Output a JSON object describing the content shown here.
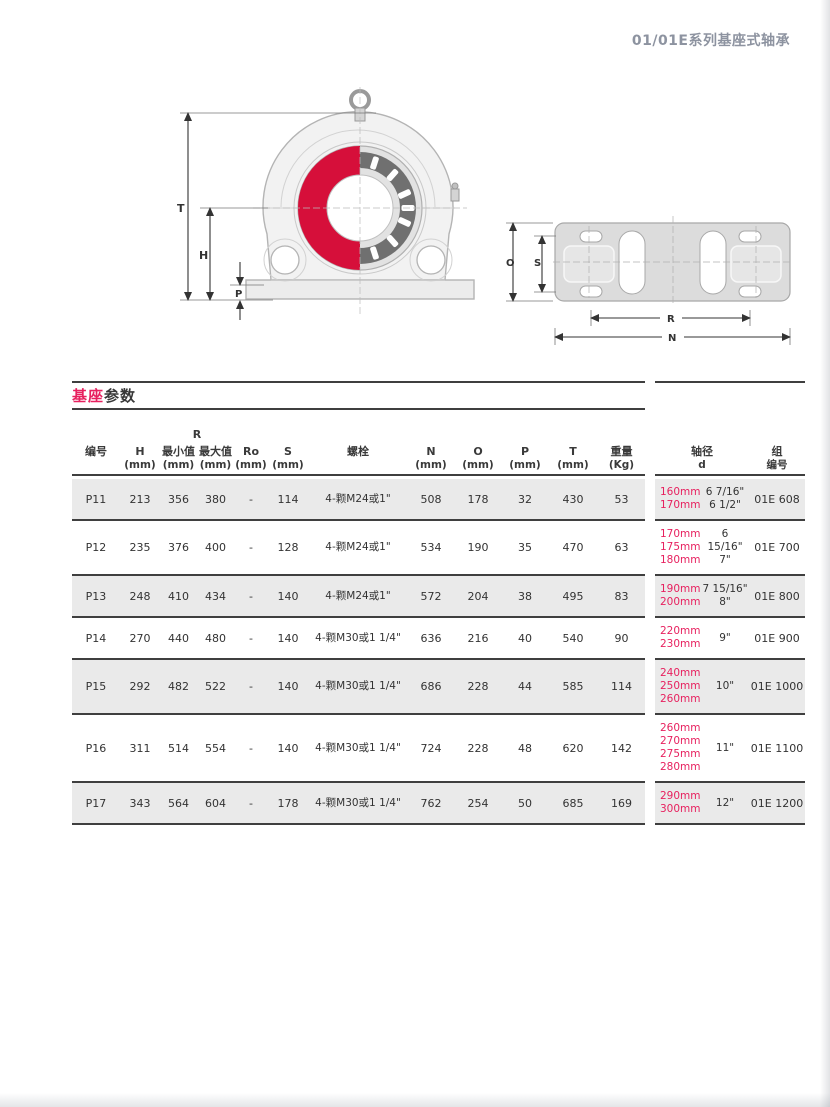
{
  "header": {
    "title": "01/01E系列基座式轴承"
  },
  "section": {
    "title_accent": "基座",
    "title_rest": "参数"
  },
  "diagram": {
    "labels": {
      "T": "T",
      "H": "H",
      "P": "P",
      "O": "O",
      "S": "S",
      "R": "R",
      "N": "N"
    }
  },
  "table": {
    "r_group_label": "R",
    "columns": [
      {
        "key": "id",
        "label": "编号",
        "unit": ""
      },
      {
        "key": "h",
        "label": "H",
        "unit": "(mm)"
      },
      {
        "key": "r_min",
        "label": "最小值",
        "unit": "(mm)"
      },
      {
        "key": "r_max",
        "label": "最大值",
        "unit": "(mm)"
      },
      {
        "key": "ro",
        "label": "Ro",
        "unit": "(mm)"
      },
      {
        "key": "s",
        "label": "S",
        "unit": "(mm)"
      },
      {
        "key": "bolt",
        "label": "螺栓",
        "unit": ""
      },
      {
        "key": "n",
        "label": "N",
        "unit": "(mm)"
      },
      {
        "key": "o",
        "label": "O",
        "unit": "(mm)"
      },
      {
        "key": "p",
        "label": "P",
        "unit": "(mm)"
      },
      {
        "key": "t",
        "label": "T",
        "unit": "(mm)"
      },
      {
        "key": "weight",
        "label": "重量",
        "unit": "(Kg)"
      }
    ],
    "right_columns": [
      {
        "label": "轴径",
        "sub": "d"
      },
      {
        "label": "组",
        "sub": "编号"
      }
    ],
    "rows": [
      {
        "id": "P11",
        "h": "213",
        "r_min": "356",
        "r_max": "380",
        "ro": "-",
        "s": "114",
        "bolt": "4-颗M24或1\"",
        "n": "508",
        "o": "178",
        "p": "32",
        "t": "430",
        "weight": "53",
        "d_mm": [
          "160mm",
          "170mm"
        ],
        "d_inch": [
          "6 7/16\"",
          "6 1/2\""
        ],
        "group": "01E 608",
        "shaded": true
      },
      {
        "id": "P12",
        "h": "235",
        "r_min": "376",
        "r_max": "400",
        "ro": "-",
        "s": "128",
        "bolt": "4-颗M24或1\"",
        "n": "534",
        "o": "190",
        "p": "35",
        "t": "470",
        "weight": "63",
        "d_mm": [
          "170mm",
          "175mm",
          "180mm"
        ],
        "d_inch": [
          "6",
          "15/16\"",
          "7\""
        ],
        "group": "01E 700",
        "shaded": false
      },
      {
        "id": "P13",
        "h": "248",
        "r_min": "410",
        "r_max": "434",
        "ro": "-",
        "s": "140",
        "bolt": "4-颗M24或1\"",
        "n": "572",
        "o": "204",
        "p": "38",
        "t": "495",
        "weight": "83",
        "d_mm": [
          "190mm",
          "200mm"
        ],
        "d_inch": [
          "7 15/16\"",
          "8\""
        ],
        "group": "01E 800",
        "shaded": true
      },
      {
        "id": "P14",
        "h": "270",
        "r_min": "440",
        "r_max": "480",
        "ro": "-",
        "s": "140",
        "bolt": "4-颗M30或1 1/4\"",
        "n": "636",
        "o": "216",
        "p": "40",
        "t": "540",
        "weight": "90",
        "d_mm": [
          "220mm",
          "230mm"
        ],
        "d_inch": [
          "9\""
        ],
        "group": "01E 900",
        "shaded": false
      },
      {
        "id": "P15",
        "h": "292",
        "r_min": "482",
        "r_max": "522",
        "ro": "-",
        "s": "140",
        "bolt": "4-颗M30或1 1/4\"",
        "n": "686",
        "o": "228",
        "p": "44",
        "t": "585",
        "weight": "114",
        "d_mm": [
          "240mm",
          "250mm",
          "260mm"
        ],
        "d_inch": [
          "10\""
        ],
        "group": "01E 1000",
        "shaded": true
      },
      {
        "id": "P16",
        "h": "311",
        "r_min": "514",
        "r_max": "554",
        "ro": "-",
        "s": "140",
        "bolt": "4-颗M30或1 1/4\"",
        "n": "724",
        "o": "228",
        "p": "48",
        "t": "620",
        "weight": "142",
        "d_mm": [
          "260mm",
          "270mm",
          "275mm",
          "280mm"
        ],
        "d_inch": [
          "11\""
        ],
        "group": "01E 1100",
        "shaded": false
      },
      {
        "id": "P17",
        "h": "343",
        "r_min": "564",
        "r_max": "604",
        "ro": "-",
        "s": "178",
        "bolt": "4-颗M30或1 1/4\"",
        "n": "762",
        "o": "254",
        "p": "50",
        "t": "685",
        "weight": "169",
        "d_mm": [
          "290mm",
          "300mm"
        ],
        "d_inch": [
          "12\""
        ],
        "group": "01E 1200",
        "shaded": true
      }
    ]
  },
  "colors": {
    "accent": "#e7215f",
    "bearing_red": "#d60f3a",
    "row_shade": "#eaeaea",
    "rule": "#3f3f3f",
    "header_text": "#8d93a0",
    "drawing_line": "#b4b4b4"
  }
}
